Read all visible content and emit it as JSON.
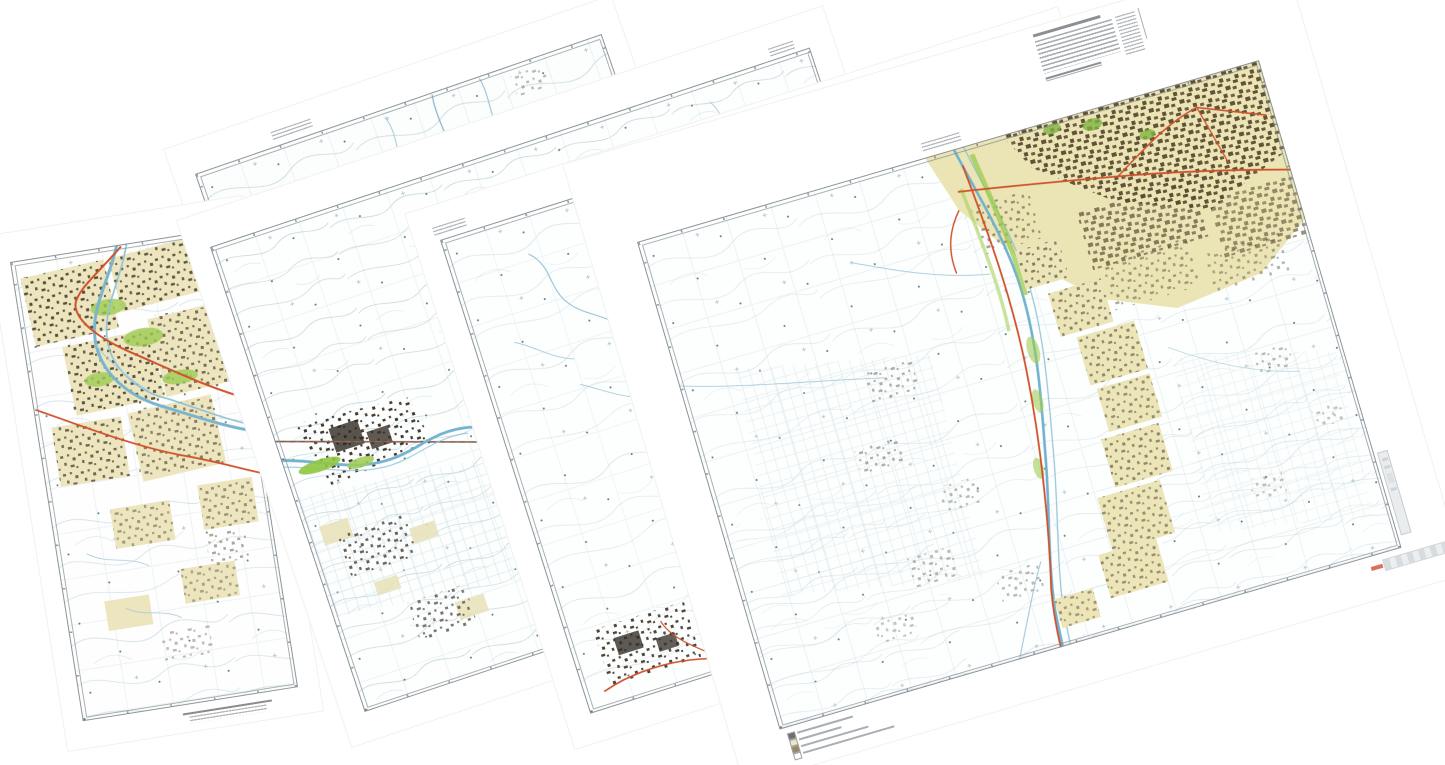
{
  "canvas": {
    "width": 1445,
    "height": 765,
    "background": "#ffffff"
  },
  "scene_type": "montage of overlapping scanned topographic map sheets",
  "palette": {
    "paper": "#ffffff",
    "map_tint": "#fdfefe",
    "contour_line": "#bdd3d9",
    "grid_line": "#7da5b4",
    "water": "#74b3cf",
    "water_light": "#8ec1d6",
    "vegetation": "#8fc641",
    "vegetation_light": "#a8d05a",
    "builtup_fill": "#ece5b8",
    "builtup_speckle": "#4d4237",
    "city_brown": "#5a4a33",
    "road_major": "#d0512c",
    "railroad": "#6b5d52",
    "neatline": "#8e9498",
    "marginalia_text": "#9aa0a6"
  },
  "sheets": [
    {
      "id": "sheet-a",
      "name": "map sheet A, backmost, only top strip visible",
      "position": {
        "left": 195,
        "top": 174
      },
      "size": {
        "width": 430,
        "height": 500
      },
      "rotation_deg": -19,
      "features": [
        "contour field",
        "small blue streams"
      ],
      "marginalia": [
        {
          "type": "sheet-label",
          "lines": 2,
          "legible": false
        }
      ]
    },
    {
      "id": "sheet-1",
      "name": "map sheet 1, leftmost, city with braided river and two red roads",
      "position": {
        "left": 10,
        "top": 262
      },
      "size": {
        "width": 218,
        "height": 465
      },
      "rotation_deg": -9,
      "features": [
        "urban blocks beige",
        "dark building speckle",
        "braided river",
        "two red major roads",
        "vegetation patches",
        "contours"
      ],
      "marginalia": [
        {
          "type": "scale-bar",
          "legible": false
        }
      ]
    },
    {
      "id": "sheet-2",
      "name": "map sheet 2, town with railroad, meandering river and field grids",
      "position": {
        "left": 210,
        "top": 247
      },
      "size": {
        "width": 632,
        "height": 490
      },
      "rotation_deg": -18.4,
      "features": [
        "dense contours",
        "black town speckle",
        "railroad",
        "meandering river",
        "bright green vegetation",
        "irrigated field grid"
      ],
      "marginalia": [
        {
          "type": "corner-label",
          "legible": false
        }
      ]
    },
    {
      "id": "sheet-3",
      "name": "map sheet 3, sparse contour plain with small town in lower-left corner",
      "position": {
        "left": 440,
        "top": 240
      },
      "size": {
        "width": 632,
        "height": 497
      },
      "rotation_deg": -17.6,
      "features": [
        "sparse contours",
        "spot-height dots",
        "small town speckle",
        "red road segment",
        "streams"
      ],
      "marginalia": [
        {
          "type": "sheet-label",
          "lines": 2,
          "legible": false
        }
      ]
    },
    {
      "id": "sheet-4",
      "name": "map sheet 4, frontmost, large city along north-south river",
      "position": {
        "left": 637,
        "top": 242
      },
      "size": {
        "width": 648,
        "height": 508
      },
      "rotation_deg": -16.3,
      "features": [
        "large tan city with brown speckle",
        "braided river north-south",
        "red road along river",
        "red road through city",
        "village chain",
        "field grids",
        "contours",
        "spot heights"
      ],
      "marginalia": [
        {
          "type": "title-block",
          "legible": false
        },
        {
          "type": "sheet-label",
          "legible": false
        },
        {
          "type": "legend",
          "rows": 4,
          "legible": false
        },
        {
          "type": "adjoining-sheet-bar",
          "legible": false
        },
        {
          "type": "scale-stamp",
          "has_red_mark": true,
          "legible": false
        }
      ]
    }
  ]
}
